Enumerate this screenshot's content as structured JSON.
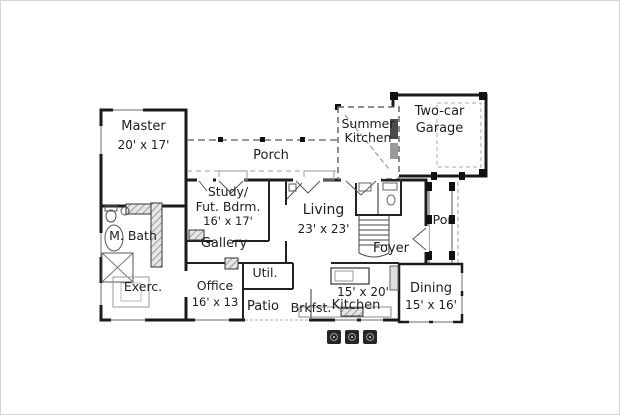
{
  "plan": {
    "rooms": {
      "master": {
        "name": "Master",
        "dims": "20' x 17'"
      },
      "porch": {
        "name": "Porch"
      },
      "summer_kitchen": {
        "line1": "Summer",
        "line2": "Kitchen"
      },
      "garage": {
        "line1": "Two-car",
        "line2": "Garage"
      },
      "study": {
        "line1": "Study/",
        "line2": "Fut. Bdrm.",
        "dims": "16' x 17'"
      },
      "living": {
        "name": "Living",
        "dims": "23' x 23'"
      },
      "m_bath": {
        "name": "M. Bath"
      },
      "gallery": {
        "name": "Gallery"
      },
      "foyer": {
        "name": "Foyer"
      },
      "por": {
        "name": "Por."
      },
      "exerc": {
        "name": "Exerc."
      },
      "office": {
        "name": "Office",
        "dims": "16' x 13"
      },
      "util": {
        "name": "Util."
      },
      "patio": {
        "name": "Patio"
      },
      "brkfst": {
        "name": "Brkfst."
      },
      "kitchen": {
        "name": "Kitchen",
        "dims": "15' x 20'"
      },
      "dining": {
        "name": "Dining",
        "dims": "15' x 16'"
      }
    },
    "colors": {
      "wall": "#1b1b1b",
      "interior_wall": "#222222",
      "dash_line": "#777777",
      "fixture_line": "#555555",
      "text": "#1e1e1e",
      "background": "#ffffff",
      "frame": "#d5d5d5",
      "paver": "#262626"
    }
  }
}
